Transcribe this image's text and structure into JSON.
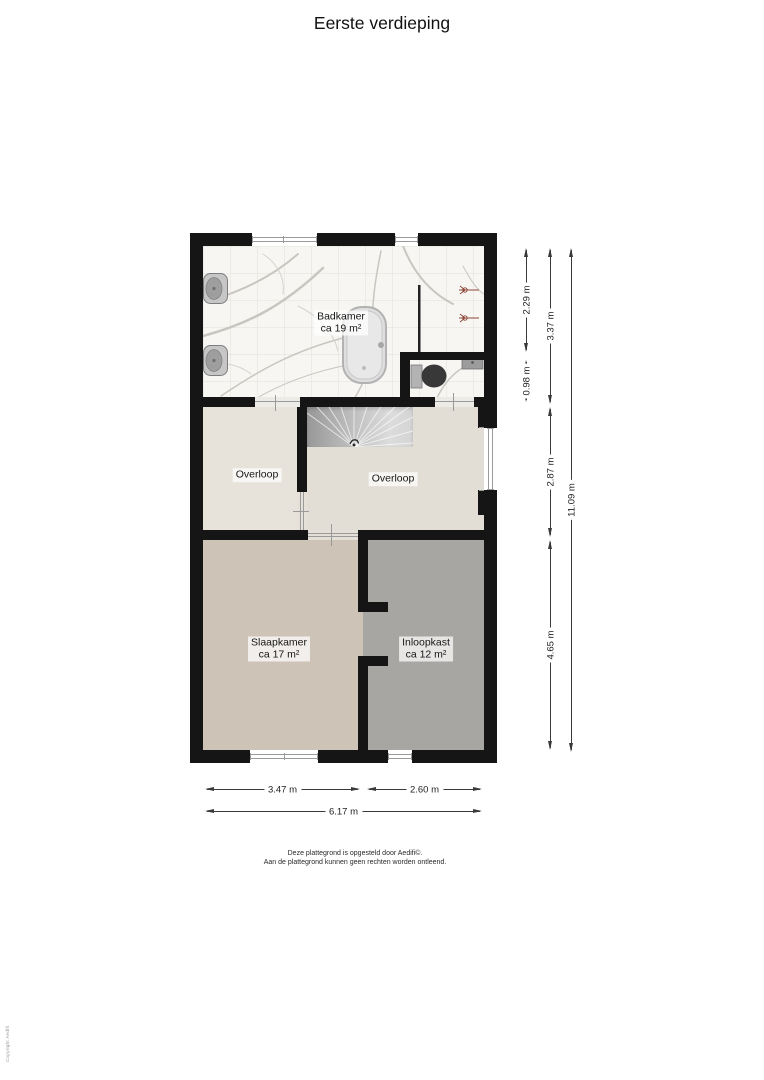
{
  "title": "Eerste verdieping",
  "rooms": {
    "badkamer": {
      "name": "Badkamer",
      "area": "ca 19 m²"
    },
    "overloop_left": {
      "name": "Overloop"
    },
    "overloop_right": {
      "name": "Overloop"
    },
    "slaapkamer": {
      "name": "Slaapkamer",
      "area": "ca 17 m²"
    },
    "inloopkast": {
      "name": "Inloopkast",
      "area": "ca 12 m²"
    }
  },
  "dims": {
    "bath_top": "2.29 m",
    "wc": "0.98 m",
    "bath_full": "3.37 m",
    "landing": "2.87 m",
    "bedroom": "4.65 m",
    "height_total": "11.09 m",
    "bedroom_w": "3.47 m",
    "closet_w": "2.60 m",
    "width_total": "6.17 m"
  },
  "footer": {
    "line1": "Deze plattegrond is opgesteld door Aedifi©.",
    "line2": "Aan de plattegrond kunnen geen rechten worden ontleend."
  },
  "copyright": "Copyright Aedifi",
  "colors": {
    "wall": "#151515",
    "bathroom_floor": "#f7f6f3",
    "landing_floor": "#e4dfd7",
    "bedroom_floor": "#cec3b7",
    "closet_floor": "#a8a6a3",
    "stairs": "#bcbcbc"
  }
}
